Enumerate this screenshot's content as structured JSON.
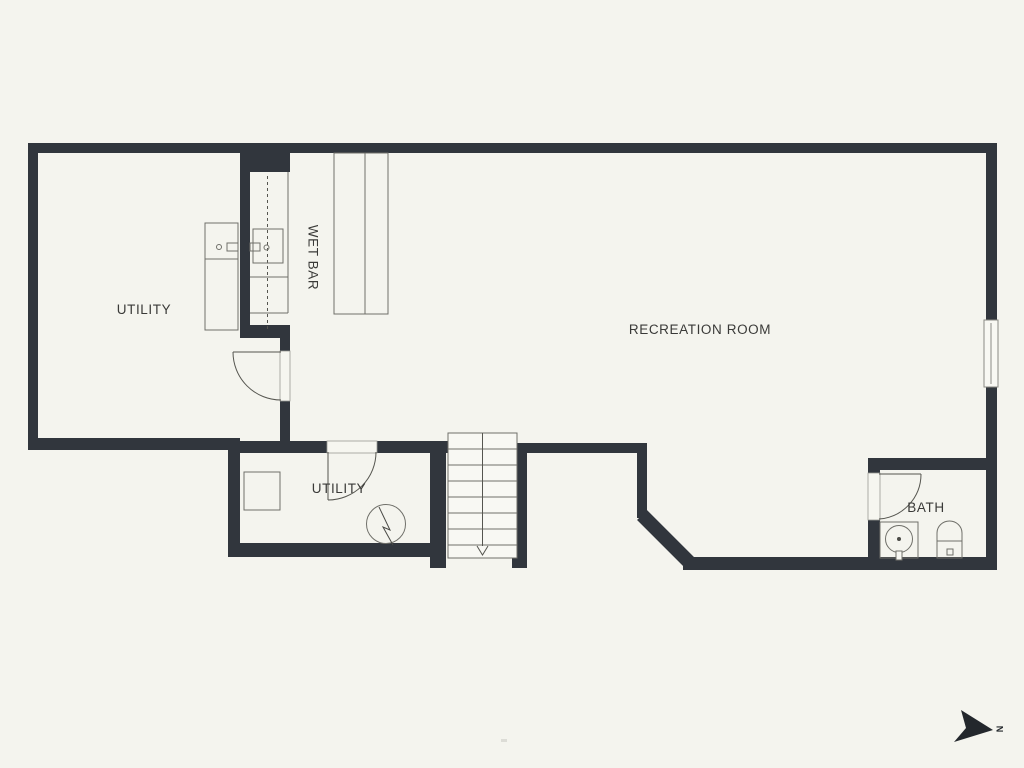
{
  "colors": {
    "background": "#f4f4ee",
    "wall": "#31363d",
    "fixture_line": "#6f6f69",
    "door_line": "#55554f",
    "text": "#3a3a38",
    "compass_arrow": "#23272c"
  },
  "floor_plan": {
    "rooms": [
      {
        "id": "utility_upper",
        "label": "UTILITY"
      },
      {
        "id": "wet_bar",
        "label": "WET BAR"
      },
      {
        "id": "recreation_room",
        "label": "RECREATION ROOM"
      },
      {
        "id": "utility_lower",
        "label": "UTILITY"
      },
      {
        "id": "bath",
        "label": "BATH"
      }
    ],
    "compass": {
      "label": "N",
      "direction": "right"
    },
    "fixtures": [
      "laundry-sink-counter",
      "wet-bar-sink-counter",
      "bar-island-counter",
      "window",
      "stairs-down",
      "door-swing",
      "storage-cabinet",
      "water-heater",
      "bath-vanity-sink",
      "toilet"
    ]
  }
}
